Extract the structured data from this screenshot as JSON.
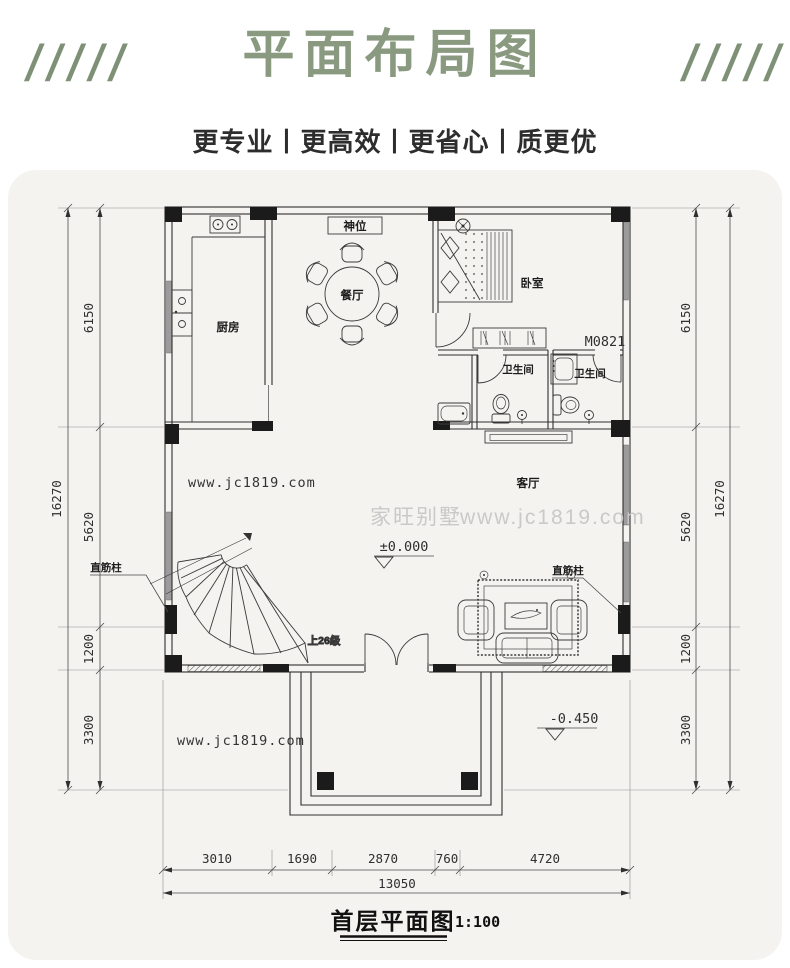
{
  "header": {
    "slashes": "/////",
    "title": "平面布局图",
    "subtitle": "更专业丨更高效丨更省心丨质更优"
  },
  "plan": {
    "rooms": {
      "kitchen": "厨房",
      "dining": "餐厅",
      "altar": "神位",
      "bedroom": "卧室",
      "bath_left": "卫生间",
      "bath_right": "卫生间",
      "living": "客厅"
    },
    "annotations": {
      "door_tag": "M0821",
      "stair_note": "上26级",
      "column_label": "直筋柱",
      "level_main": "±0.000",
      "level_porch": "-0.450"
    },
    "watermarks": {
      "brand": "家旺别墅",
      "site": "www.jc1819.com"
    },
    "dims_vertical": {
      "total": "16270",
      "segments": [
        "6150",
        "5620",
        "1200",
        "3300"
      ]
    },
    "dims_bottom": {
      "segments": [
        "3010",
        "1690",
        "2870",
        "760",
        "4720"
      ],
      "total": "13050"
    },
    "caption": {
      "title": "首层平面图",
      "scale": "1:100"
    }
  },
  "colors": {
    "accent_green": "#8a9a80",
    "card_bg": "#f4f3f0",
    "ink": "#2f2f2f",
    "watermark_gray": "#c9c9c9"
  }
}
